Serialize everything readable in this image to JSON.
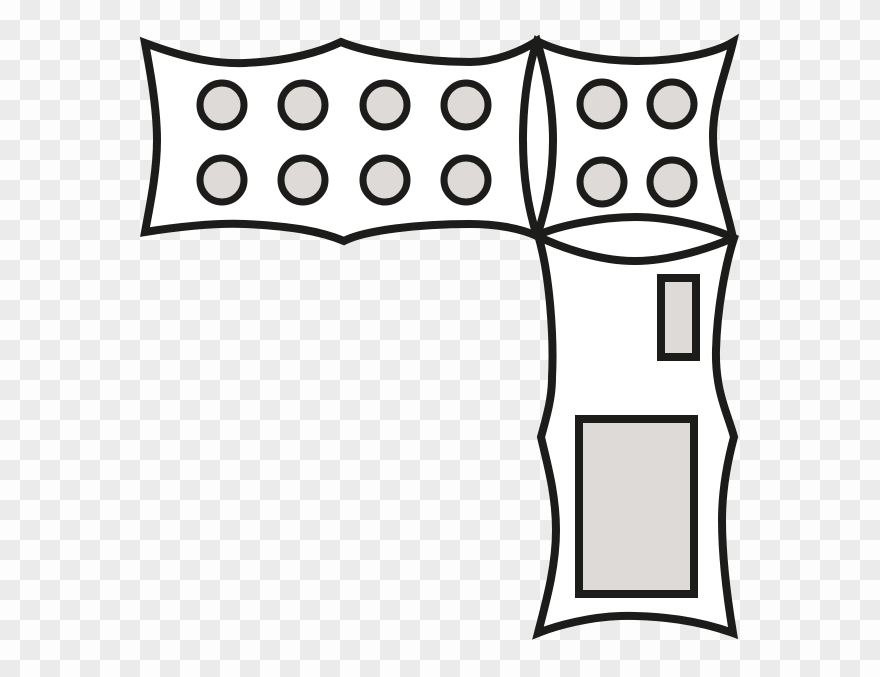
{
  "canvas": {
    "width": 880,
    "height": 677
  },
  "background": {
    "kind": "transparency-checkerboard",
    "cell_size_px": 20,
    "gray_cell_color": "#ebebeb",
    "white_cell_color": "#fdfdfd",
    "top_left_cell": "white"
  },
  "artwork": {
    "description": "Black line-art clipart of three wavy-edged banner rectangles: a wide horizontal banner holding eight gray studs (2 rows x 4 columns), a square banner holding four gray studs (2 x 2), and a tall vertical banner holding a small and a large gray rectangle; adjacent banners overlap in lens-shaped seams",
    "colors": {
      "outline": "#1c1c1a",
      "banner_fill": "#ffffff",
      "shape_fill": "#dedad8"
    },
    "outline_stroke_width": 8,
    "banners": [
      {
        "id": "banner-horizontal",
        "stud_count": 8,
        "outline_path": "M145,43 C190,60 220,64 245,63 C290,61 320,52 341,42 C365,52 420,62 470,62 C495,62 520,52 537,41 C547,75 553,110 553,140 C553,175 547,205 537,236 C520,228 495,224 470,224 C420,224 365,230 344,241 C320,231 290,226 245,224 C220,223 190,225 145,232 C150,205 157,172 157,140 C157,108 150,70 145,43 Z"
      },
      {
        "id": "banner-square",
        "stud_count": 4,
        "outline_path": "M537,41 C560,53 600,61 638,61 C678,61 715,53 733,42 C726,72 713,102 713,136 C713,172 726,205 733,238 C710,248 670,261 635,261 C598,261 560,247 537,236 C527,205 523,172 523,140 C523,106 527,72 537,41 Z"
      },
      {
        "id": "banner-vertical",
        "stud_count": 0,
        "outline_path": "M538,235 C558,226 600,217 635,217 C672,217 712,228 734,238 C725,266 717,310 716,350 C715,392 728,414 734,437 C727,463 722,490 722,520 C722,557 727,597 733,633 C700,621 660,615 620,616 C590,617 558,625 538,633 C546,602 556,567 556,530 C556,494 547,463 541,437 C548,412 552,396 552,378 C554,338 550,275 538,235 Z"
      }
    ],
    "studs": {
      "radius": 22,
      "ring_stroke_width": 7,
      "groups": [
        {
          "banner": "banner-horizontal",
          "rows": 2,
          "cols": 4,
          "centers": [
            [
              222,
              105
            ],
            [
              303,
              105
            ],
            [
              385,
              105
            ],
            [
              466,
              105
            ],
            [
              222,
              180
            ],
            [
              303,
              180
            ],
            [
              385,
              180
            ],
            [
              466,
              180
            ]
          ]
        },
        {
          "banner": "banner-square",
          "rows": 2,
          "cols": 2,
          "centers": [
            [
              602,
              104
            ],
            [
              672,
              104
            ],
            [
              602,
              182
            ],
            [
              672,
              182
            ]
          ]
        }
      ]
    },
    "inner_rects": [
      {
        "id": "small-inner-rect",
        "x": 661,
        "y": 278,
        "width": 35,
        "height": 79,
        "stroke_width": 8
      },
      {
        "id": "large-inner-rect",
        "x": 579,
        "y": 419,
        "width": 115,
        "height": 175,
        "stroke_width": 8
      }
    ]
  }
}
